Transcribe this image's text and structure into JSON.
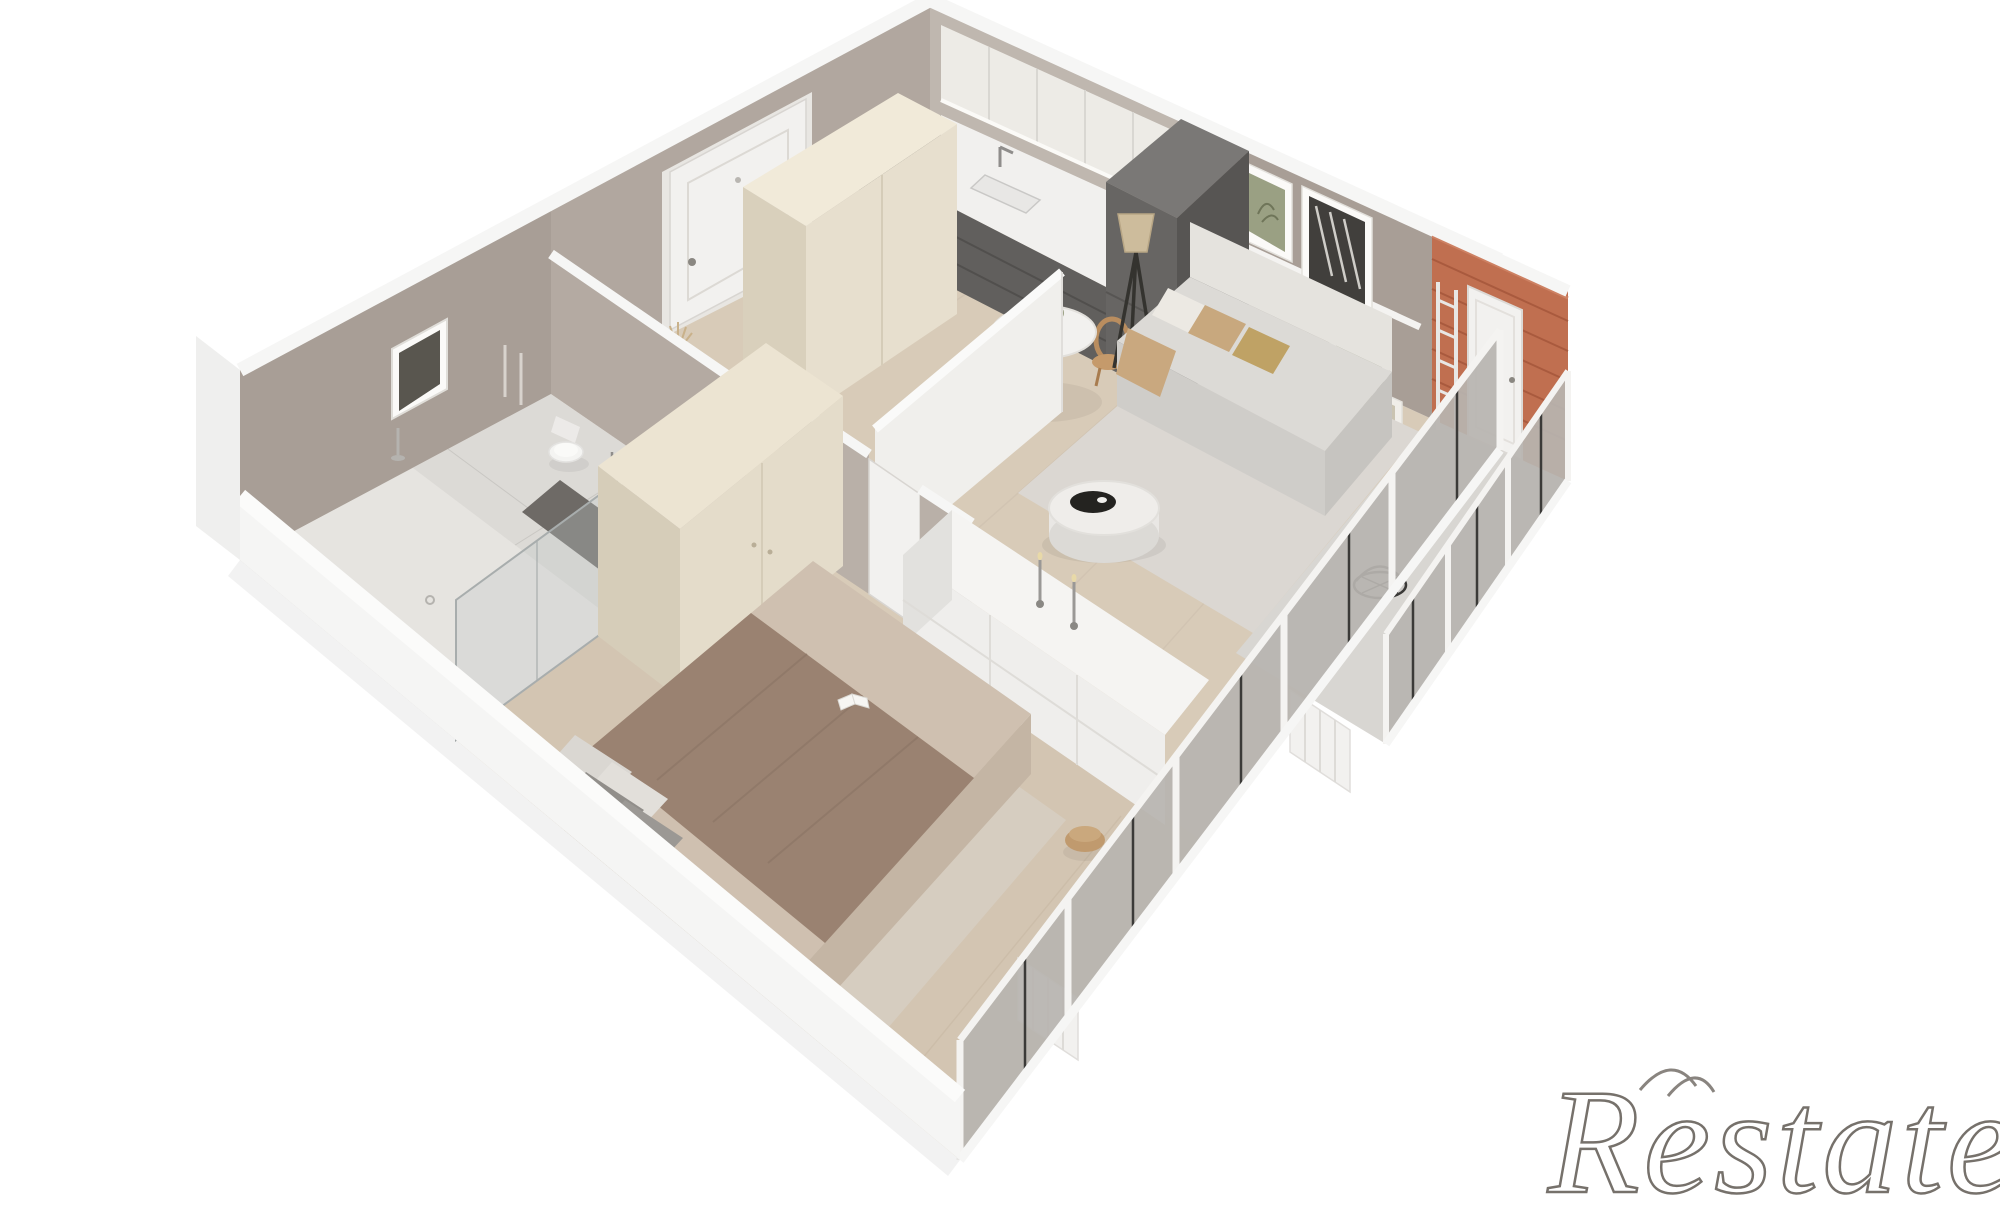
{
  "watermark": {
    "text": "Restate"
  },
  "scene": {
    "type": "3d-floor-plan-render",
    "view": "isometric cutaway of a one-bedroom apartment",
    "rooms": [
      {
        "id": "entrance-hall",
        "label": "Entrance hall",
        "features": [
          "white front door",
          "terracotta vase with dried grass"
        ]
      },
      {
        "id": "kitchen",
        "label": "Kitchen",
        "features": [
          "white upper cabinets",
          "dark grey base units with sink and tap",
          "tall dark appliance column",
          "tall cream storage column"
        ]
      },
      {
        "id": "dining-area",
        "label": "Dining area",
        "features": [
          "round white pedestal table",
          "flower centrepiece",
          "two rattan chairs"
        ]
      },
      {
        "id": "living-room",
        "label": "Living room",
        "features": [
          "grey sofa with white, tan and gold cushions",
          "round white coffee table with black tray",
          "tripod floor lamp",
          "gallery picture ledge with botanical and zebra prints",
          "area rug"
        ]
      },
      {
        "id": "corridor",
        "label": "Corridor",
        "features": [
          "bright white partition wall",
          "interior door to bedroom"
        ]
      },
      {
        "id": "bathroom",
        "label": "Bathroom",
        "features": [
          "walk-in shower with glass screen",
          "toilet",
          "washbasin",
          "towel rail",
          "framed print",
          "dark floor mat"
        ]
      },
      {
        "id": "bedroom",
        "label": "Bedroom",
        "features": [
          "double bed with brown blanket",
          "grey and white pillows",
          "open book on bed",
          "cream double wardrobe",
          "white chest of drawers with two candlesticks",
          "tan pouf",
          "area rug"
        ]
      },
      {
        "id": "balcony",
        "label": "Balcony",
        "features": [
          "brick feature wall",
          "white balcony door",
          "decor ladder",
          "wire basket",
          "full-height glazing"
        ]
      }
    ]
  },
  "palette": {
    "background": "#ffffff",
    "wood_floor": "#d8cbb8",
    "bedroom_floor": "#d3c5b2",
    "tile_floor": "#dcdad6",
    "balcony_floor": "#d8d6d2",
    "rug_living": "#dbd7d2",
    "rug_bedroom": "#d6cdc0",
    "wall_taupe": "#a89e96",
    "wall_taupe_light": "#b4aaa2",
    "wall_kitchen": "#bfb7af",
    "wall_cap": "#f6f6f5",
    "door": "#f2f1ef",
    "kitchen_upper": "#edebe6",
    "kitchen_dark": "#615f5d",
    "counter": "#f1f0ee",
    "cabinet_cream": "#e7dfce",
    "wardrobe_cream": "#e4dcca",
    "sofa_body": "#dcdad6",
    "bed_blanket": "#9a8271",
    "bed_sheet": "#cfc0b0",
    "dresser": "#efeeec",
    "brick": "#c06f50",
    "glass": "#b7b4b0",
    "watermark_stroke": "#6b655f"
  }
}
